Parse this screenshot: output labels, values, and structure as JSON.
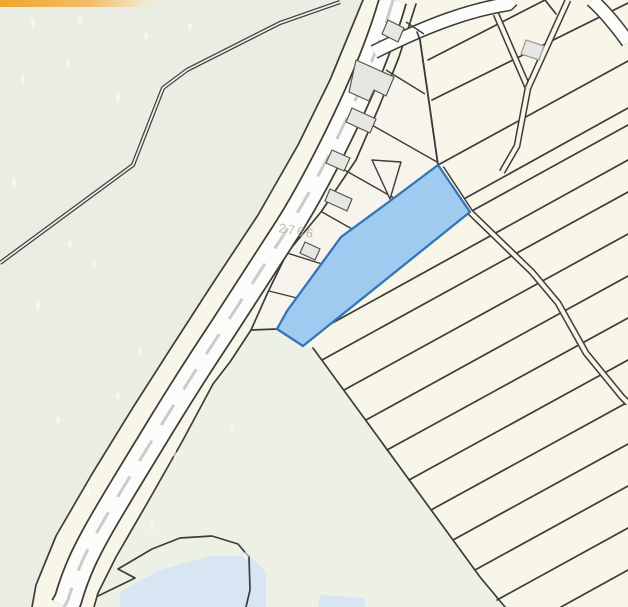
{
  "map": {
    "road_label": "2766",
    "selected_parcel": {
      "status": "selected"
    },
    "layers": [
      "vegetation",
      "parcels",
      "strip-parcels",
      "buildings",
      "roads",
      "tracks",
      "water",
      "selection"
    ],
    "colors": {
      "canvas-cream": "#f8f6e9",
      "strip-cream": "#f6f4ec",
      "vegetation-green": "#e9ede3",
      "vegetation-light": "#edf0e5",
      "parcel-line": "#3c3c38",
      "building-fill": "#e6e6e2",
      "building-line": "#55554f",
      "road-surface": "#fcfcfa",
      "road-dash": "#c8c8c6",
      "selection-fill": "#9fcbf1",
      "selection-stroke": "#3474b5",
      "water-fill": "#d8e6f3",
      "toolbar-orange": "#f0a62c",
      "label-gray": "#ababa7"
    }
  }
}
